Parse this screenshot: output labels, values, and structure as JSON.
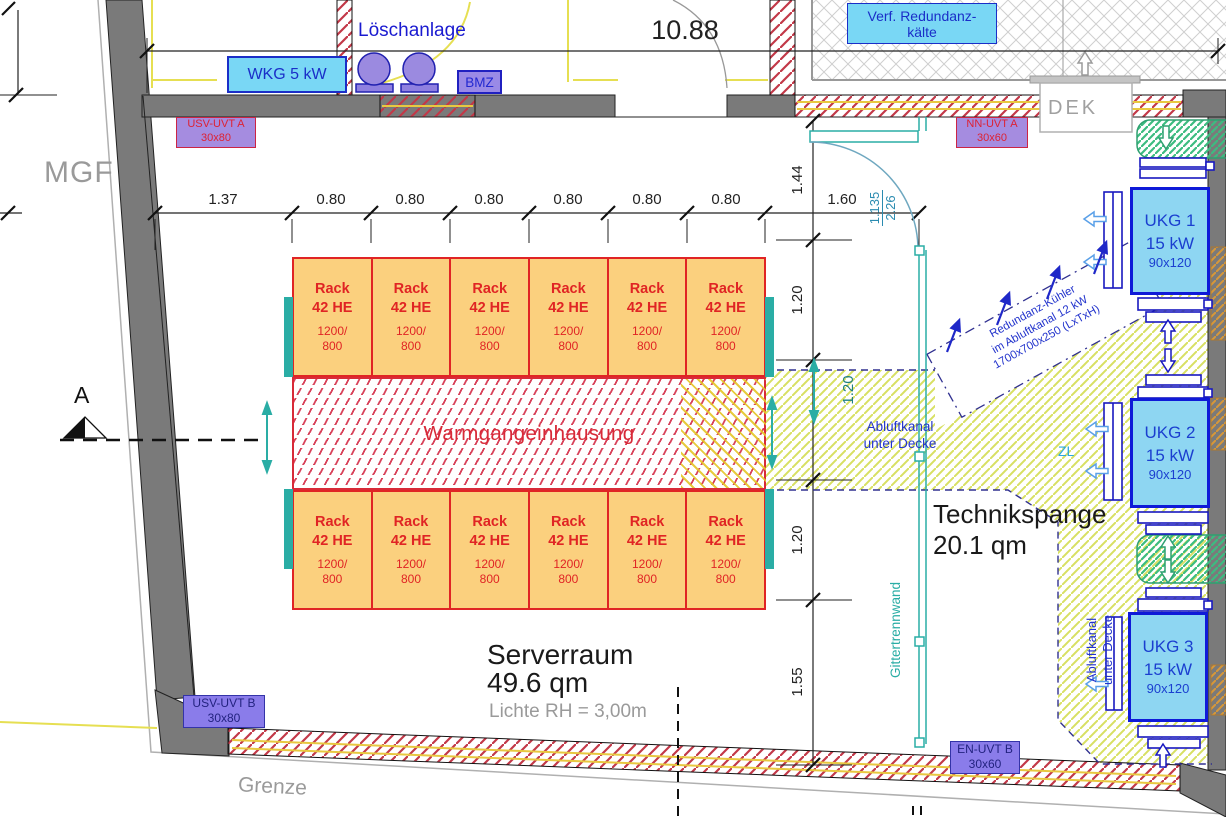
{
  "plan": {
    "rooms": {
      "mgf": "MGF",
      "loeschanlage": "Löschanlage",
      "grenze": "Grenze",
      "serverraum": {
        "name": "Serverraum",
        "area": "49.6 qm",
        "clear_height": "Lichte RH = 3,00m"
      },
      "technikspange": {
        "name": "Technikspange",
        "area": "20.1 qm"
      },
      "verf_redundanzkaelte": {
        "line1": "Verf. Redundanz-",
        "line2": "kälte"
      }
    },
    "equipment": {
      "wkg": "WKG 5 kW",
      "bmz": "BMZ",
      "dek": "DEK",
      "usv_uvt_a": {
        "name": "USV-UVT A",
        "size": "30x80"
      },
      "nn_uvt_a": {
        "name": "NN-UVT A",
        "size": "30x60"
      },
      "usv_uvt_b": {
        "name": "USV-UVT B",
        "size": "30x80"
      },
      "en_uvt_b": {
        "name": "EN-UVT B",
        "size": "30x60"
      },
      "ukg1": {
        "name": "UKG 1",
        "power": "15 kW",
        "size": "90x120"
      },
      "ukg2": {
        "name": "UKG 2",
        "power": "15 kW",
        "size": "90x120"
      },
      "ukg3": {
        "name": "UKG 3",
        "power": "15 kW",
        "size": "90x120"
      },
      "redundanz_kuehler": {
        "line1": "Redundanz-Kühler",
        "line2": "im Abluftkanal 12 kW",
        "line3": "1700x700x250 (LxTxH)"
      }
    },
    "rack": {
      "title": "Rack",
      "height": "42 HE",
      "dim1": "1200/",
      "dim2": "800",
      "per_row": 6,
      "rows": 2
    },
    "zones": {
      "warmgang": "Warmgangeinhausung",
      "abluftkanal": {
        "line1": "Abluftkanal",
        "line2": "unter Decke"
      },
      "abluftkanal_vertikal": {
        "line1": "Abluftkanal",
        "line2": "unter Decke"
      },
      "gittertrennwand": "Gittertrennwand",
      "zl": "ZL"
    },
    "dimensions": {
      "overall_width": "10.88",
      "rack_chain": [
        "1.37",
        "0.80",
        "0.80",
        "0.80",
        "0.80",
        "0.80",
        "0.80"
      ],
      "door_width": "1.60",
      "door_fraction": {
        "top": "1.135",
        "bottom": "2.26"
      },
      "right_chain": [
        "1.44",
        "1.20",
        "1.20",
        "1.20",
        "1.55"
      ],
      "section_marker": "A"
    },
    "colors": {
      "wall_gray": "#7a7a7a",
      "rack_fill": "#fbd07e",
      "rack_red": "#e02424",
      "cyan_fill": "#79d7f5",
      "ukg_fill": "#8ed6f2",
      "navy": "#1f28c8",
      "teal": "#2aada5",
      "purple_box": "#a58ce0",
      "hatch_yellow_green": "#d8e062",
      "hatch_green": "#3cbc80",
      "hatch_red": "#c23848",
      "gray_text": "#999999"
    }
  }
}
